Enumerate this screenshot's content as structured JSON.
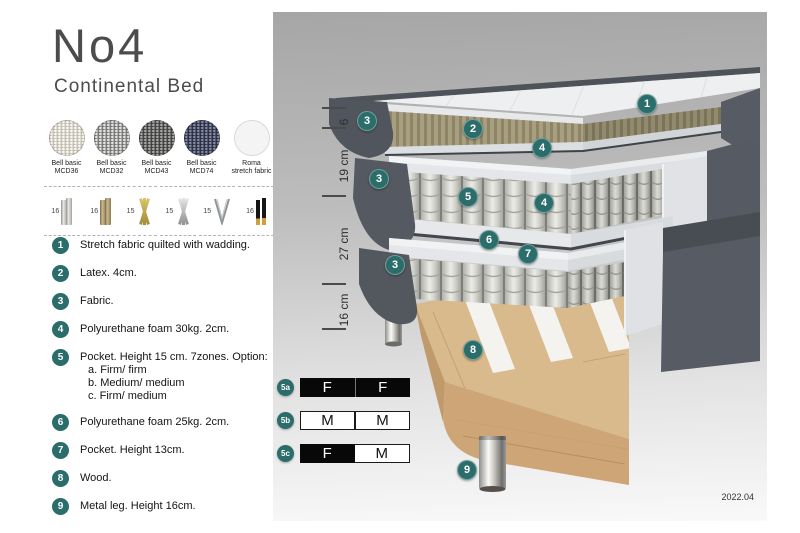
{
  "product": {
    "title": "No4",
    "subtitle": "Continental Bed"
  },
  "fabric_swatches": [
    {
      "name": "Bell basic",
      "code": "MCD36",
      "color": "#d9d5c9"
    },
    {
      "name": "Bell basic",
      "code": "MCD32",
      "color": "#9b9b99"
    },
    {
      "name": "Bell basic",
      "code": "MCD43",
      "color": "#5d5d5b"
    },
    {
      "name": "Bell basic",
      "code": "MCD74",
      "color": "#3e4357"
    },
    {
      "name": "Roma",
      "code": "stretch fabric",
      "color": "#f4f4f4"
    }
  ],
  "leg_options": [
    {
      "height": "16",
      "style": "cylinder-silver"
    },
    {
      "height": "16",
      "style": "cylinder-bronze"
    },
    {
      "height": "15",
      "style": "twisted-gold"
    },
    {
      "height": "15",
      "style": "twisted-silver"
    },
    {
      "height": "15",
      "style": "hairpin"
    },
    {
      "height": "16",
      "style": "black-gold-tip"
    }
  ],
  "parts_list": [
    {
      "number": "1",
      "text": "Stretch fabric quilted with wadding."
    },
    {
      "number": "2",
      "text": "Latex. 4cm."
    },
    {
      "number": "3",
      "text": "Fabric."
    },
    {
      "number": "4",
      "text": "Polyurethane foam 30kg. 2cm."
    },
    {
      "number": "5",
      "text": "Pocket. Height 15 cm. 7zones. Option:",
      "options": [
        "a. Firm/ firm",
        "b. Medium/ medium",
        "c. Firm/ medium"
      ]
    },
    {
      "number": "6",
      "text": "Polyurethane foam 25kg. 2cm."
    },
    {
      "number": "7",
      "text": "Pocket. Height 13cm."
    },
    {
      "number": "8",
      "text": "Wood."
    },
    {
      "number": "9",
      "text": "Metal leg. Height 16cm."
    }
  ],
  "diagram": {
    "dimensions": [
      "6",
      "19 cm",
      "27 cm",
      "16 cm"
    ],
    "callouts": [
      "1",
      "2",
      "3",
      "3",
      "3",
      "4",
      "4",
      "5",
      "6",
      "7",
      "8",
      "9"
    ],
    "firmness_options": [
      {
        "label": "5a",
        "cells": [
          "F",
          "F"
        ]
      },
      {
        "label": "5b",
        "cells": [
          "M",
          "M"
        ]
      },
      {
        "label": "5c",
        "cells": [
          "F",
          "M"
        ]
      }
    ],
    "version": "2022.04"
  },
  "colors": {
    "accent_teal": "#2b6d6a",
    "fabric_gray": "#575c64",
    "latex_olive": "#a59d7e",
    "wood": "#d9ba8c"
  }
}
